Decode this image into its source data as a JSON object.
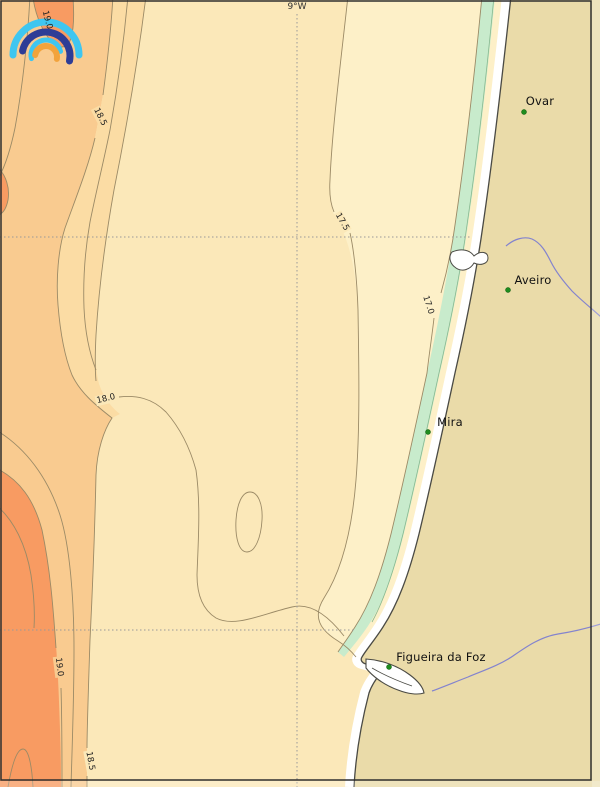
{
  "map": {
    "gridline_label": "9°W",
    "logo": "rainbow-arcs-logo",
    "isotherm_values": [
      "17.0",
      "17.5",
      "18.0",
      "18.5",
      "19.0"
    ],
    "contour_labels": [
      {
        "value": "19.0"
      },
      {
        "value": "18.5"
      },
      {
        "value": "17.5"
      },
      {
        "value": "17.0"
      },
      {
        "value": "18.0"
      },
      {
        "value": "19.0"
      },
      {
        "value": "18.5"
      }
    ],
    "cities": [
      {
        "name": "Ovar"
      },
      {
        "name": "Aveiro"
      },
      {
        "name": "Mira"
      },
      {
        "name": "Figueira da Foz"
      }
    ],
    "colors": {
      "sea_band_main": "#FBE8B9",
      "sea_band_cool": "#FDF0C8",
      "sea_band_warm": "#FBDCA4",
      "sea_band_warmer": "#F9CB90",
      "sea_band_hot": "#F89B62",
      "coastal_green": "#C8EBCC",
      "coastal_green_line": "#88B890",
      "beach": "#FFFFFF",
      "land": "#EADBA9",
      "river": "#8383CE",
      "city_marker": "#1E8C1E",
      "contour_line": "#9B8A66",
      "coastline": "#4A4A44",
      "grid": "#999999",
      "frame": "#2F2F2F",
      "logo_cyan": "#3FC6F0",
      "logo_navy": "#2E3D96",
      "logo_orange": "#F2A33C"
    }
  }
}
